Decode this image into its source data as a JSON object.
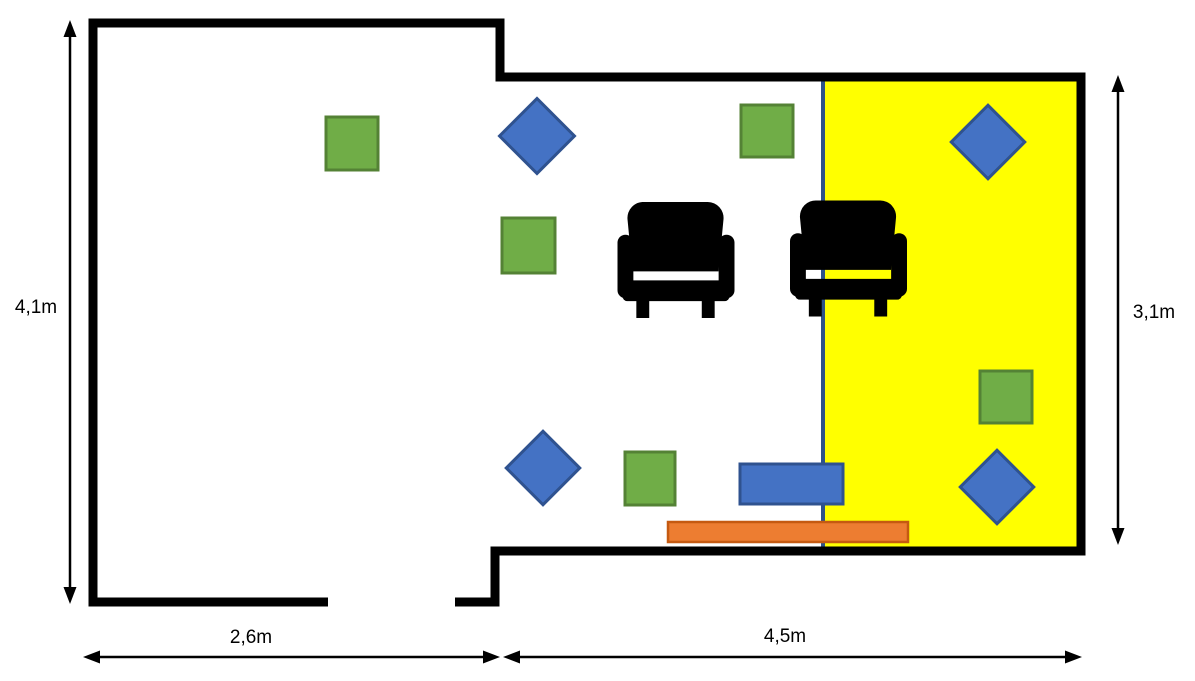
{
  "diagram_title": "floor-plan",
  "dimensions": {
    "left": "4,1m",
    "right": "3,1m",
    "bottom_left": "2,6m",
    "bottom_right": "4,5m"
  },
  "colors": {
    "wall": "#000000",
    "zone": "#FFFF00",
    "divider": "#2E5288",
    "green_fill": "#70AD47",
    "green_border": "#548235",
    "blue_fill": "#4472C4",
    "blue_border": "#2F528F",
    "orange_fill": "#ED7D31",
    "orange_border": "#C55A11",
    "chair": "#000000"
  },
  "plan": {
    "tv_zone": {
      "x": 823,
      "y": 80,
      "w": 254,
      "h": 467
    },
    "green_squares": [
      {
        "x": 326,
        "y": 117,
        "w": 52,
        "h": 53
      },
      {
        "x": 502,
        "y": 218,
        "w": 53,
        "h": 55
      },
      {
        "x": 741,
        "y": 105,
        "w": 52,
        "h": 52
      },
      {
        "x": 980,
        "y": 371,
        "w": 52,
        "h": 52
      },
      {
        "x": 625,
        "y": 452,
        "w": 50,
        "h": 53
      }
    ],
    "blue_diamonds": [
      {
        "cx": 537,
        "cy": 136,
        "size": 53,
        "rotation": 45
      },
      {
        "cx": 988,
        "cy": 142,
        "size": 52,
        "rotation": 45
      },
      {
        "cx": 543,
        "cy": 468,
        "size": 52,
        "rotation": 45
      },
      {
        "cx": 997,
        "cy": 487,
        "size": 52,
        "rotation": 45
      }
    ],
    "armchairs": [
      {
        "x": 617,
        "y": 202,
        "w": 118,
        "h": 116
      },
      {
        "x": 790,
        "y": 200,
        "w": 117,
        "h": 117
      }
    ],
    "blue_rect": {
      "x": 740,
      "y": 464,
      "w": 103,
      "h": 40
    },
    "orange_bar": {
      "x": 668,
      "y": 522,
      "w": 240,
      "h": 20
    }
  }
}
